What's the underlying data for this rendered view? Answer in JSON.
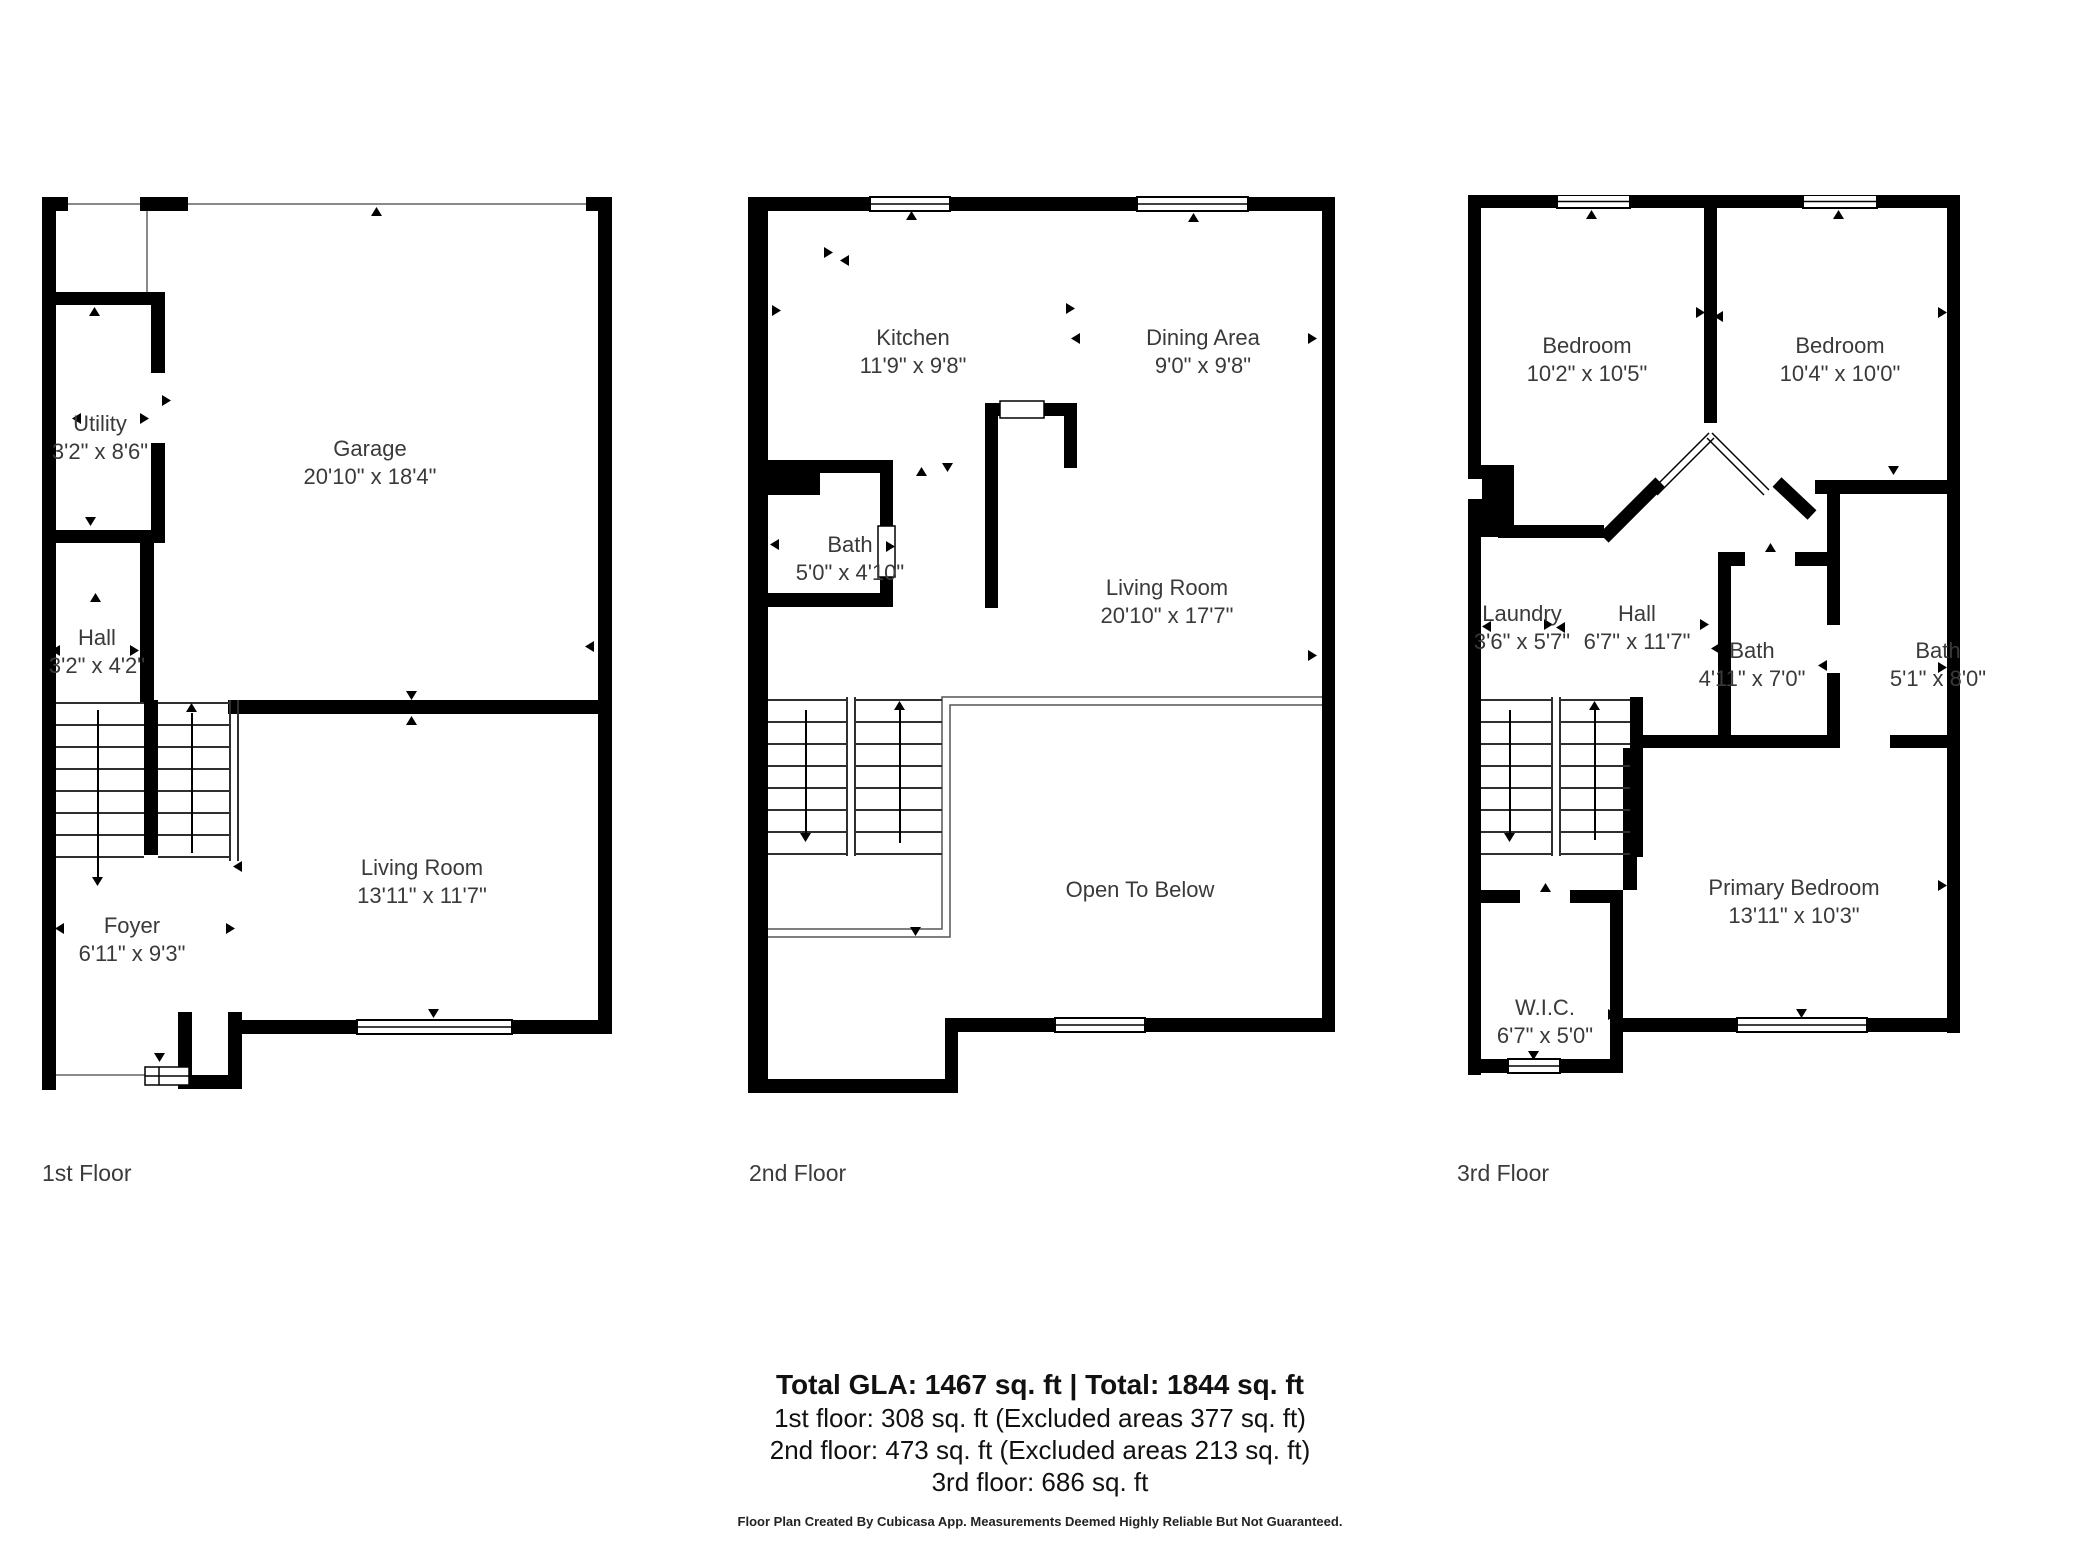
{
  "colors": {
    "wall": "#000000",
    "label_text": "#3a3a3a",
    "background": "#ffffff"
  },
  "floors": [
    {
      "caption": "1st Floor",
      "rooms": {
        "utility": {
          "name": "Utility",
          "dims": "3'2\" x 8'6\""
        },
        "garage": {
          "name": "Garage",
          "dims": "20'10\" x 18'4\""
        },
        "hall": {
          "name": "Hall",
          "dims": "3'2\" x 4'2\""
        },
        "living": {
          "name": "Living Room",
          "dims": "13'11\" x 11'7\""
        },
        "foyer": {
          "name": "Foyer",
          "dims": "6'11\" x 9'3\""
        }
      }
    },
    {
      "caption": "2nd Floor",
      "rooms": {
        "kitchen": {
          "name": "Kitchen",
          "dims": "11'9\" x 9'8\""
        },
        "dining": {
          "name": "Dining Area",
          "dims": "9'0\" x 9'8\""
        },
        "bath": {
          "name": "Bath",
          "dims": "5'0\" x 4'10\""
        },
        "living": {
          "name": "Living Room",
          "dims": "20'10\" x 17'7\""
        },
        "open_to_below": {
          "name": "Open To Below"
        }
      }
    },
    {
      "caption": "3rd Floor",
      "rooms": {
        "bedroom_left": {
          "name": "Bedroom",
          "dims": "10'2\" x 10'5\""
        },
        "bedroom_right": {
          "name": "Bedroom",
          "dims": "10'4\" x 10'0\""
        },
        "laundry": {
          "name": "Laundry",
          "dims": "3'6\" x 5'7\""
        },
        "hall": {
          "name": "Hall",
          "dims": "6'7\" x 11'7\""
        },
        "bath_left": {
          "name": "Bath",
          "dims": "4'11\" x 7'0\""
        },
        "bath_right": {
          "name": "Bath",
          "dims": "5'1\" x 8'0\""
        },
        "primary": {
          "name": "Primary Bedroom",
          "dims": "13'11\" x 10'3\""
        },
        "wic": {
          "name": "W.I.C.",
          "dims": "6'7\" x 5'0\""
        }
      }
    }
  ],
  "summary": {
    "total": "Total GLA: 1467 sq. ft | Total: 1844 sq. ft",
    "floor1": "1st floor: 308 sq. ft (Excluded areas 377 sq. ft)",
    "floor2": "2nd floor: 473 sq. ft (Excluded areas 213 sq. ft)",
    "floor3": "3rd floor: 686 sq. ft"
  },
  "footer": "Floor Plan Created By Cubicasa App. Measurements Deemed Highly Reliable But Not Guaranteed."
}
